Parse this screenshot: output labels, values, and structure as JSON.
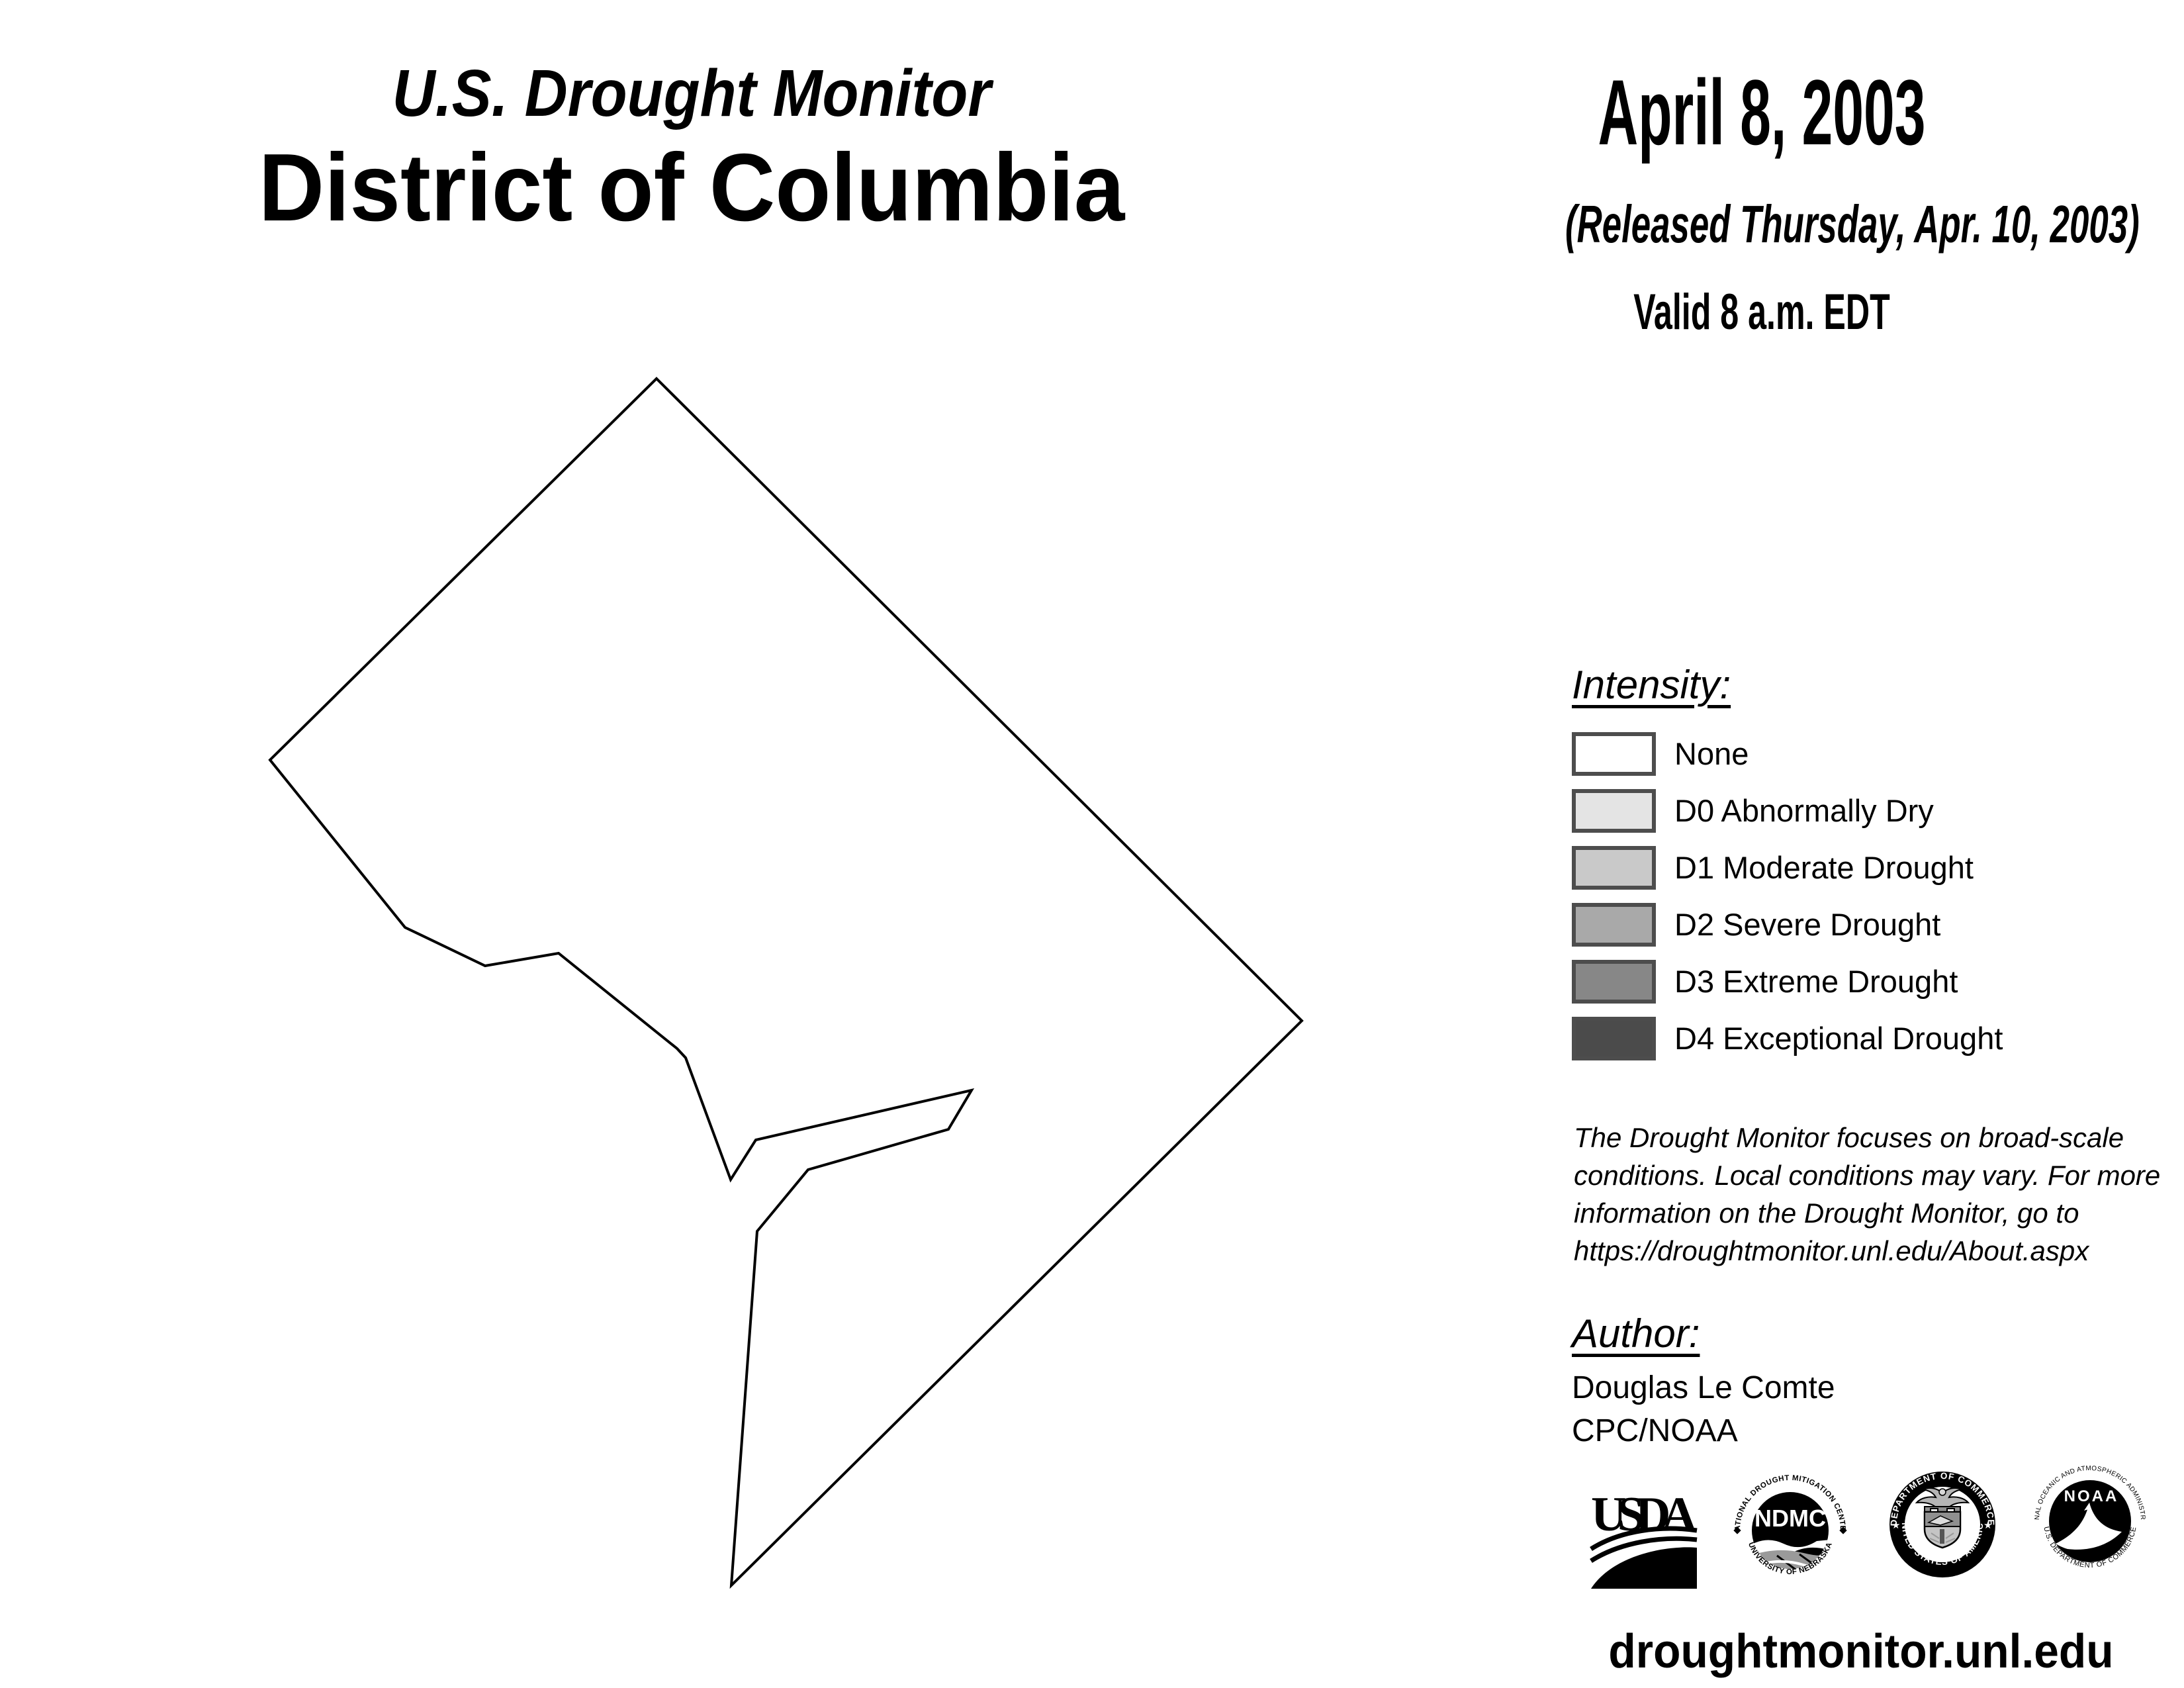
{
  "header": {
    "program": "U.S. Drought Monitor",
    "region": "District of Columbia"
  },
  "date_block": {
    "date": "April 8, 2003",
    "released": "(Released Thursday, Apr. 10, 2003)",
    "valid": "Valid 8 a.m. EDT"
  },
  "map": {
    "region": "District of Columbia",
    "depicted_condition": "None (no drought shading shown)",
    "outline_points": "992,572 1967,1542 1105,2395 1144,1860 1221,1767 1433,1706 1468,1647 1142,1722 1104,1782 1036,1598 1023,1584 844,1440 733,1459 612,1401 408,1148",
    "fill": "#ffffff",
    "stroke": "#000000",
    "stroke_width": 4
  },
  "legend": {
    "title": "Intensity:",
    "swatch_border_color": "#4d4d4d",
    "items": [
      {
        "code": "",
        "label": "None",
        "color": "#ffffff"
      },
      {
        "code": "D0",
        "label": "D0 Abnormally Dry",
        "color": "#e4e4e4"
      },
      {
        "code": "D1",
        "label": "D1 Moderate Drought",
        "color": "#c9c9c9"
      },
      {
        "code": "D2",
        "label": "D2 Severe Drought",
        "color": "#a9a9a9"
      },
      {
        "code": "D3",
        "label": "D3 Extreme Drought",
        "color": "#878787"
      },
      {
        "code": "D4",
        "label": "D4 Exceptional Drought",
        "color": "#4b4b4b"
      }
    ]
  },
  "disclaimer": "The Drought Monitor focuses on broad-scale\nconditions. Local conditions may vary. For more\ninformation on the Drought Monitor, go to\nhttps://droughtmonitor.unl.edu/About.aspx",
  "author": {
    "title": "Author:",
    "name": "Douglas Le Comte",
    "org": "CPC/NOAA"
  },
  "logos": {
    "usda": {
      "text": "USDA"
    },
    "ndmc": {
      "ring_top": "NATIONAL DROUGHT MITIGATION CENTER",
      "ring_bottom": "UNIVERSITY OF NEBRASKA",
      "center": "NDMC"
    },
    "doc": {
      "ring_top": "DEPARTMENT OF COMMERCE",
      "ring_bottom": "UNITED STATES OF AMERICA",
      "star": "★"
    },
    "noaa": {
      "ring_top": "NATIONAL OCEANIC AND ATMOSPHERIC ADMINISTRATION",
      "ring_bottom": "U.S. DEPARTMENT OF COMMERCE",
      "center": "NOAA"
    }
  },
  "footer": {
    "url": "droughtmonitor.unl.edu"
  }
}
